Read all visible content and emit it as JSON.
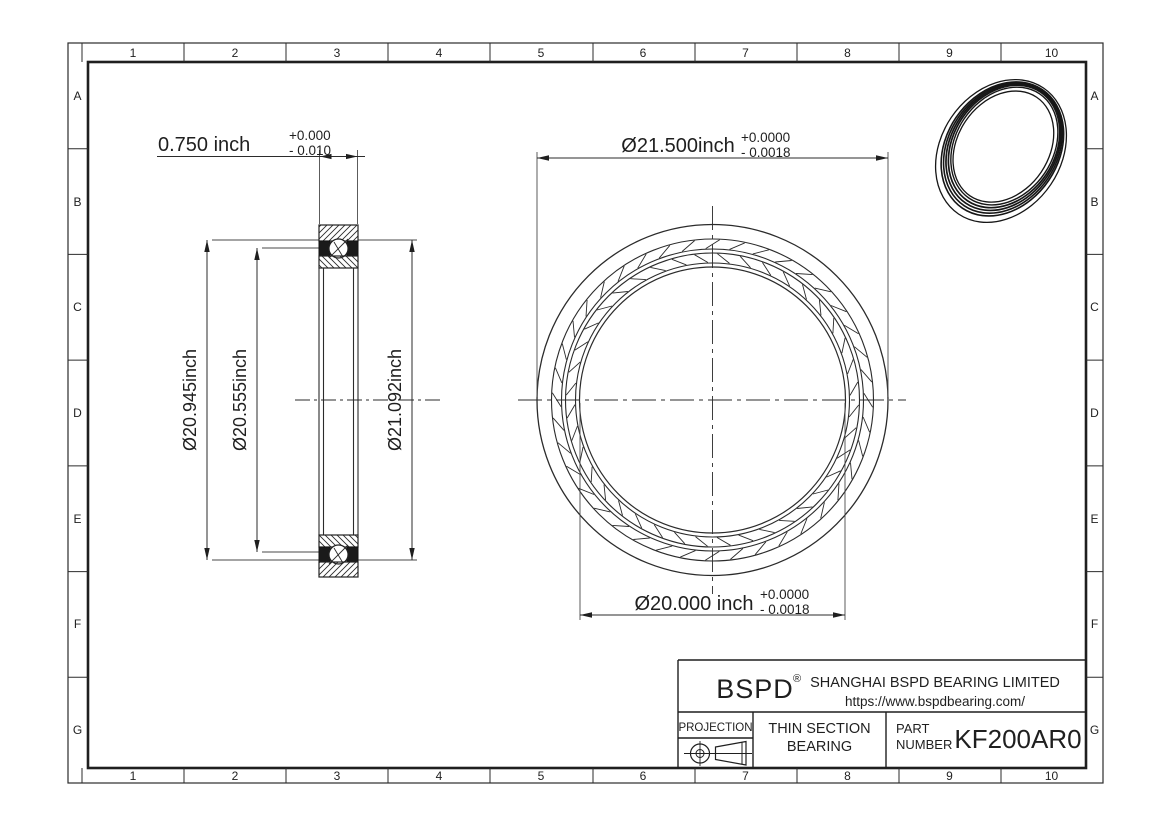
{
  "sheet": {
    "zones": {
      "cols": [
        "1",
        "2",
        "3",
        "4",
        "5",
        "6",
        "7",
        "8",
        "9",
        "10"
      ],
      "rows": [
        "A",
        "B",
        "C",
        "D",
        "E",
        "F",
        "G"
      ]
    },
    "dimensions": {
      "width": {
        "label": "0.750 inch",
        "tol_plus": "+0.000",
        "tol_minus": "- 0.010"
      },
      "outer_diameter": {
        "label": "Ø21.500inch",
        "tol_plus": "+0.0000",
        "tol_minus": "- 0.0018"
      },
      "bore_diameter": {
        "label": "Ø20.000 inch",
        "tol_plus": "+0.0000",
        "tol_minus": "- 0.0018"
      },
      "inner_ring_od": "Ø20.945inch",
      "land_diameter": "Ø20.555inch",
      "outer_ring_id": "Ø21.092inch"
    },
    "title_block": {
      "logo": "BSPD",
      "reg_mark": "®",
      "company": "SHANGHAI BSPD BEARING LIMITED",
      "website": "https://www.bspdbearing.com/",
      "projection_label": "PROJECTION",
      "product_line1": "THIN SECTION",
      "product_line2": "BEARING",
      "part_label_line1": "PART",
      "part_label_line2": "NUMBER",
      "part_number": "KF200AR0"
    },
    "colors": {
      "line": "#2b2b2b",
      "frame": "#1f1f1f",
      "background": "#ffffff"
    }
  }
}
